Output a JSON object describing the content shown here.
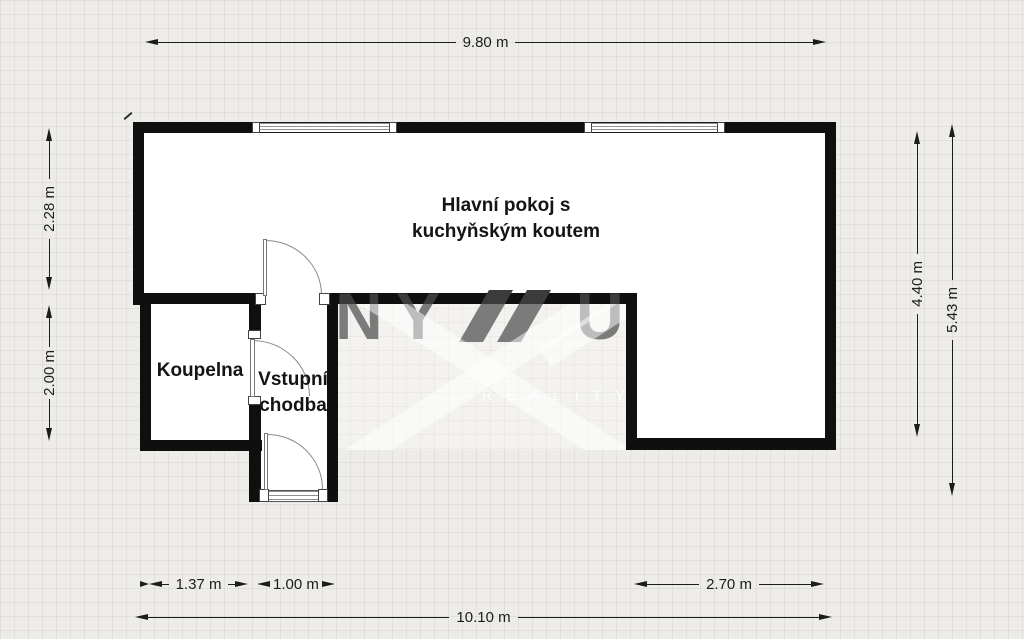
{
  "page": {
    "background_color": "#edece8",
    "grid_line_color": "#e0ded9"
  },
  "floorplan": {
    "rooms": {
      "main": {
        "name_line1": "Hlavní pokoj s",
        "name_line2": "kuchyňským koutem"
      },
      "bathroom": {
        "name": "Koupelna"
      },
      "hall": {
        "name_line1": "Vstupní",
        "name_line2": "chodba"
      }
    },
    "dimensions": {
      "top_width": "9.80 m",
      "bottom_width": "10.10 m",
      "left_upper": "2.28 m",
      "left_lower": "2.00 m",
      "right_inner": "4.40 m",
      "right_outer": "5.43 m",
      "bathroom_width": "1.37 m",
      "hall_width": "1.00 m",
      "extension_width": "2.70 m"
    },
    "watermark": {
      "letter_1": "N",
      "letter_2": "Y",
      "letter_3": "U",
      "subtext": "REALITY"
    },
    "colors": {
      "wall": "#0f0f0f",
      "room_fill": "#ffffff",
      "dimension_line": "#1c1c1c",
      "watermark_dark": "#3b3b3b"
    }
  }
}
